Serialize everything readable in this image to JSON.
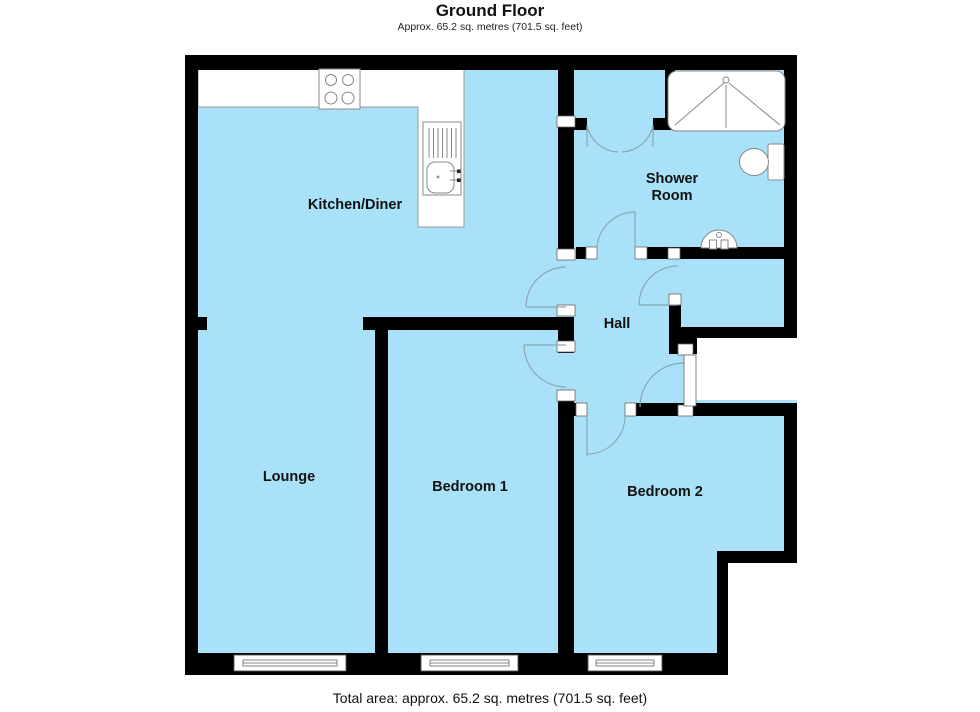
{
  "header": {
    "title": "Ground Floor",
    "subtitle": "Approx. 65.2 sq. metres (701.5 sq. feet)"
  },
  "footer": {
    "total_area": "Total area: approx. 65.2 sq. metres (701.5 sq. feet)"
  },
  "rooms": {
    "kitchen_diner": "Kitchen/Diner",
    "lounge": "Lounge",
    "bedroom1": "Bedroom 1",
    "bedroom2": "Bedroom 2",
    "hall": "Hall",
    "shower_line1": "Shower",
    "shower_line2": "Room"
  },
  "fixtures": {
    "hob": "4-ring-hob-icon",
    "sink": "kitchen-sink-drainer-icon",
    "shower_tray": "shower-tray-icon",
    "toilet": "toilet-icon",
    "basin": "wash-basin-icon",
    "windows": [
      "lounge-window",
      "bedroom1-window",
      "bedroom2-window"
    ]
  },
  "colors": {
    "floor": "#A9E2F8",
    "wall": "#000000",
    "fixstroke": "#888888",
    "arc": "#8AA5B5",
    "bg": "#FFFFFF",
    "text": "#111111"
  }
}
